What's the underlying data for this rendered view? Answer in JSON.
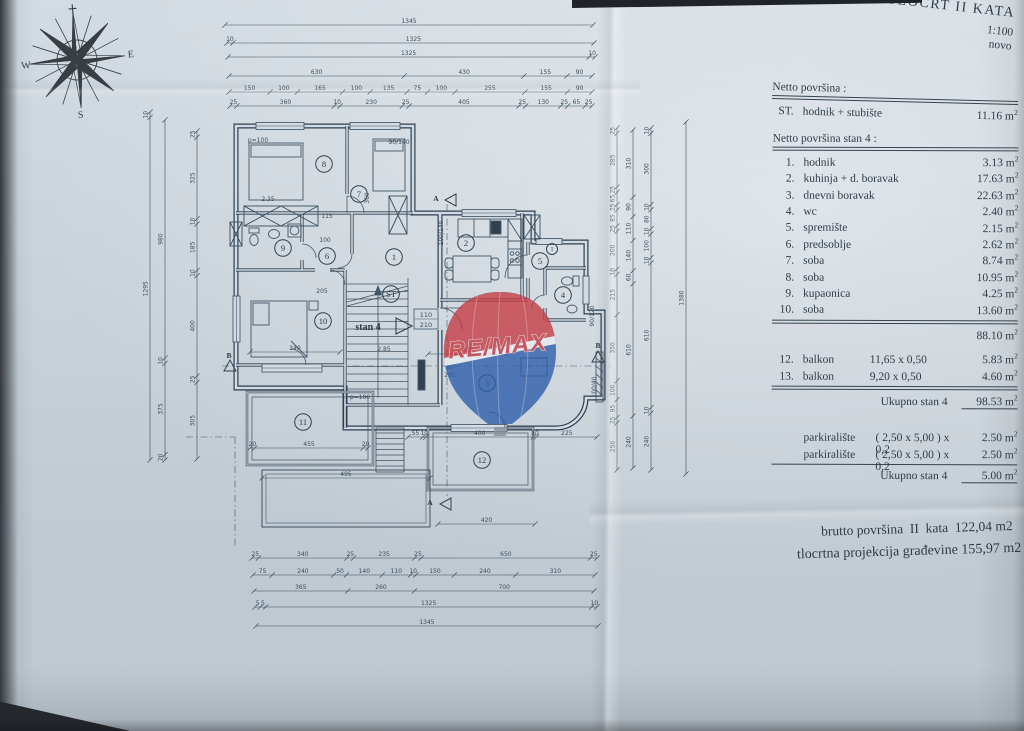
{
  "title_block": {
    "line1": "TLOCRT II KATA",
    "line2": "1:100",
    "line3": "novo"
  },
  "compass": {
    "w": "W",
    "e": "E",
    "s": "S"
  },
  "watermark": {
    "text": "RE/MAX"
  },
  "area_table": {
    "netto_label": "Netto površina :",
    "st_row": {
      "no": "ST.",
      "name": "hodnik + stubište",
      "value": "11.16"
    },
    "stan_label": "Netto površina stan  4 :",
    "unit": "m",
    "unit_sup": "2",
    "rooms": [
      {
        "no": "1.",
        "name": "hodnik",
        "value": "3.13"
      },
      {
        "no": "2.",
        "name": "kuhinja + d. boravak",
        "value": "17.63"
      },
      {
        "no": "3.",
        "name": "dnevni boravak",
        "value": "22.63"
      },
      {
        "no": "4.",
        "name": "wc",
        "value": "2.40"
      },
      {
        "no": "5.",
        "name": "spremište",
        "value": "2.15"
      },
      {
        "no": "6.",
        "name": "predsoblje",
        "value": "2.62"
      },
      {
        "no": "7.",
        "name": "soba",
        "value": "8.74"
      },
      {
        "no": "8.",
        "name": "soba",
        "value": "10.95"
      },
      {
        "no": "9.",
        "name": "kupaonica",
        "value": "4.25"
      },
      {
        "no": "10.",
        "name": "soba",
        "value": "13.60"
      }
    ],
    "subtotal_value": "88.10",
    "balconies": [
      {
        "no": "12.",
        "name": "balkon",
        "dims": "11,65 x 0,50",
        "value": "5.83"
      },
      {
        "no": "13.",
        "name": "balkon",
        "dims": "9,20 x 0,50",
        "value": "4.60"
      }
    ],
    "total_label": "Ukupno stan 4",
    "total_value": "98.53",
    "parking": [
      {
        "name": "parkiralište",
        "dims": "( 2,50 x 5,00 ) x 0,2",
        "value": "2.50"
      },
      {
        "name": "parkiralište",
        "dims": "( 2,50 x 5,00 ) x 0,2",
        "value": "2.50"
      }
    ],
    "parking_total_label": "Ukupno stan 4",
    "parking_total_value": "5.00"
  },
  "footer": {
    "line1": "brutto površina  II  kata  122,04 m2",
    "line2": "tlocrtna projekcija građevine 155,97 m2"
  },
  "plan": {
    "unit_label": "stan 4",
    "door_tag": [
      "110",
      "210"
    ],
    "rooms": [
      {
        "n": "8",
        "x": 324,
        "y": 164
      },
      {
        "n": "7",
        "x": 359,
        "y": 194
      },
      {
        "n": "9",
        "x": 283,
        "y": 248
      },
      {
        "n": "6",
        "x": 327,
        "y": 256
      },
      {
        "n": "1",
        "x": 394,
        "y": 257
      },
      {
        "n": "2",
        "x": 466,
        "y": 243
      },
      {
        "n": "5",
        "x": 540,
        "y": 261
      },
      {
        "n": "1",
        "x": 552,
        "y": 249,
        "r": 5.5
      },
      {
        "n": "4",
        "x": 563,
        "y": 295
      },
      {
        "n": "ST",
        "x": 391,
        "y": 294
      },
      {
        "n": "10",
        "x": 323,
        "y": 321
      },
      {
        "n": "3",
        "x": 487,
        "y": 383
      },
      {
        "n": "11",
        "x": 303,
        "y": 422
      },
      {
        "n": "12",
        "x": 482,
        "y": 460
      }
    ],
    "markers": [
      {
        "t": "A",
        "x": 436,
        "y": 201
      },
      {
        "t": "A",
        "x": 430,
        "y": 505
      },
      {
        "t": "B",
        "x": 598,
        "y": 348
      },
      {
        "t": "B",
        "x": 229,
        "y": 358
      }
    ],
    "labels": [
      {
        "t": "p=100",
        "x": 258,
        "y": 142
      },
      {
        "t": "2.35",
        "x": 268,
        "y": 201
      },
      {
        "t": "115",
        "x": 327,
        "y": 218
      },
      {
        "t": "100",
        "x": 325,
        "y": 242
      },
      {
        "t": "205",
        "x": 322,
        "y": 293
      },
      {
        "t": "360",
        "x": 369,
        "y": 198,
        "r": -90
      },
      {
        "t": "90/140",
        "x": 399,
        "y": 144
      },
      {
        "t": "100/140",
        "x": 443,
        "y": 233,
        "r": -90
      },
      {
        "t": "80",
        "x": 450,
        "y": 369
      },
      {
        "t": "205",
        "x": 450,
        "y": 377
      },
      {
        "t": "p=100",
        "x": 360,
        "y": 399
      },
      {
        "t": "90/120",
        "x": 594,
        "y": 316,
        "r": -90
      },
      {
        "t": "100/40",
        "x": 596,
        "y": 387,
        "r": -90
      },
      {
        "t": "2.85",
        "x": 384,
        "y": 351
      }
    ],
    "dim_chains": [
      {
        "o": "h",
        "y": 25,
        "x1": 225,
        "x2": 593,
        "labels": [
          "1345"
        ]
      },
      {
        "o": "h",
        "y": 43,
        "x1": 227,
        "x2": 594,
        "labels": [
          "10",
          "1325"
        ]
      },
      {
        "o": "h",
        "y": 57,
        "x1": 228,
        "x2": 595,
        "labels": [
          "1325",
          "10"
        ]
      },
      {
        "o": "h",
        "y": 76,
        "x1": 229,
        "x2": 592,
        "labels": [
          "630",
          "430",
          "155",
          "90"
        ]
      },
      {
        "o": "h",
        "y": 92,
        "x1": 229,
        "x2": 592,
        "labels": [
          "150",
          "100",
          "165",
          "100",
          "135",
          "75",
          "100",
          "255",
          "155",
          "90"
        ]
      },
      {
        "o": "h",
        "y": 106,
        "x1": 230,
        "x2": 592,
        "labels": [
          "25",
          "360",
          "10",
          "230",
          "25",
          "405",
          "25",
          "130",
          "25",
          "65",
          "25"
        ]
      },
      {
        "o": "h",
        "y": 558,
        "x1": 252,
        "x2": 597,
        "labels": [
          "25",
          "340",
          "25",
          "235",
          "25",
          "650",
          "25"
        ]
      },
      {
        "o": "h",
        "y": 575,
        "x1": 253,
        "x2": 595,
        "labels": [
          "75",
          "240",
          "50",
          "140",
          "110",
          "10",
          "150",
          "240",
          "310"
        ]
      },
      {
        "o": "h",
        "y": 591,
        "x1": 254,
        "x2": 594,
        "labels": [
          "365",
          "260",
          "700"
        ]
      },
      {
        "o": "h",
        "y": 607,
        "x1": 255,
        "x2": 597,
        "labels": [
          "5",
          "5",
          "1325",
          "10"
        ]
      },
      {
        "o": "h",
        "y": 626,
        "x1": 256,
        "x2": 598,
        "labels": [
          "1345"
        ]
      },
      {
        "o": "v",
        "x": 150,
        "y1": 112,
        "y2": 460,
        "labels": [
          "10",
          "1295"
        ]
      },
      {
        "o": "v",
        "x": 165,
        "y1": 120,
        "y2": 460,
        "labels": [
          "980",
          "10",
          "375",
          "20"
        ]
      },
      {
        "o": "v",
        "x": 197,
        "y1": 131,
        "y2": 459,
        "labels": [
          "25",
          "325",
          "10",
          "185",
          "10",
          "400",
          "25",
          "305"
        ]
      },
      {
        "o": "v",
        "x": 617,
        "y1": 128,
        "y2": 470,
        "labels": [
          "25",
          "285",
          "25",
          "65",
          "25",
          "85",
          "25",
          "200",
          "10",
          "215",
          "350",
          "100",
          "95",
          "25",
          "250"
        ]
      },
      {
        "o": "v",
        "x": 633,
        "y1": 130,
        "y2": 468,
        "labels": [
          "310",
          "90",
          "110",
          "140",
          "60",
          "610",
          "240"
        ]
      },
      {
        "o": "v",
        "x": 651,
        "y1": 128,
        "y2": 470,
        "labels": [
          "10",
          "300",
          "10",
          "80",
          "10",
          "100",
          "10",
          "610",
          "10",
          "240"
        ]
      },
      {
        "o": "v",
        "x": 686,
        "y1": 122,
        "y2": 474,
        "labels": [
          "1380"
        ]
      },
      {
        "o": "h",
        "y": 437,
        "x1": 408,
        "x2": 597,
        "labels": [
          "55",
          "10",
          "400",
          "10",
          "225"
        ]
      },
      {
        "o": "h",
        "y": 448,
        "x1": 250,
        "x2": 368,
        "labels": [
          "20",
          "455",
          "20"
        ]
      },
      {
        "o": "h",
        "y": 478,
        "x1": 262,
        "x2": 430,
        "labels": [
          "495"
        ]
      },
      {
        "o": "h",
        "y": 524,
        "x1": 438,
        "x2": 535,
        "labels": [
          "420"
        ]
      },
      {
        "o": "h",
        "y": 354,
        "x1": 428,
        "x2": 508,
        "labels": [
          "405"
        ]
      },
      {
        "o": "h",
        "y": 352,
        "x1": 250,
        "x2": 340,
        "labels": [
          "340"
        ]
      }
    ]
  }
}
